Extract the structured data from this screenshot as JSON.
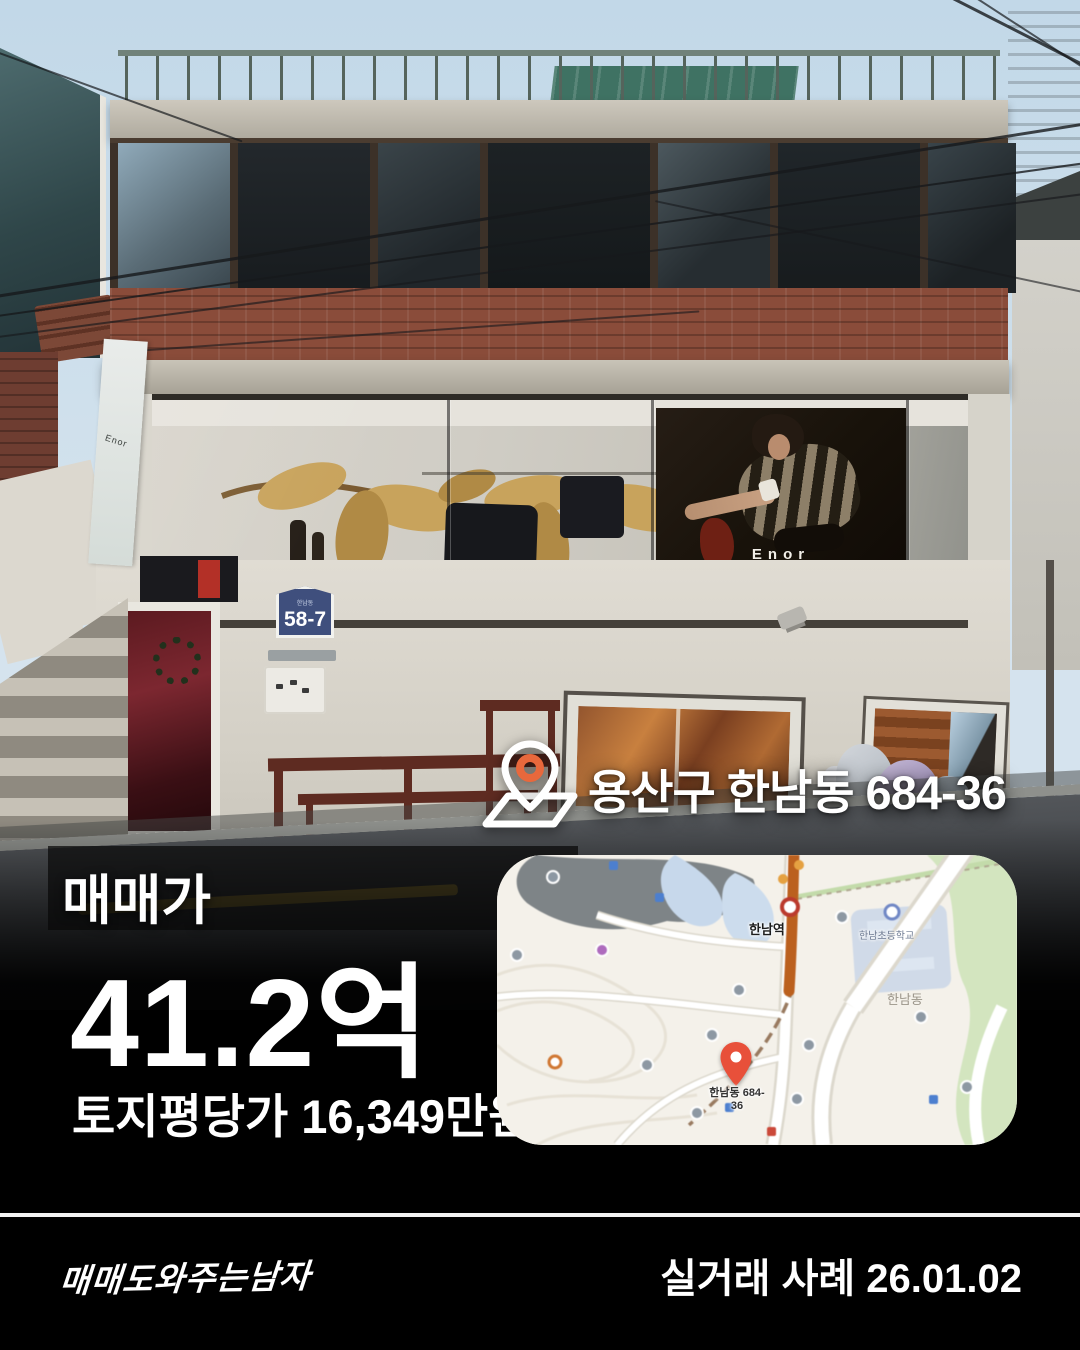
{
  "listing": {
    "location": "용산구 한남동 684-36",
    "price_label": "매매가",
    "price": "41.2억",
    "land_price": "토지평당가 16,349만원",
    "deal_note": "실거래 사례 26.01.02",
    "brand": "매매도와주는남자"
  },
  "photo": {
    "store_sign": "Enor",
    "address_plate": "58-7",
    "address_plate_caption": "한남동"
  },
  "map": {
    "station": "한남역",
    "district": "한남동",
    "school": "한남초등학교",
    "pin_label_line1": "한남동 684-",
    "pin_label_line2": "36",
    "colors": {
      "pin": "#e8503a",
      "highlight_road": "#bf5f1a",
      "park": "#d2e5bd",
      "building_zone": "#ccd8e8",
      "background": "#f4f1ea"
    }
  },
  "colors": {
    "page_background": "#000000",
    "overlay_text": "#ffffff",
    "divider": "#f2f2f2",
    "road_yellow_line": "#d7b84b"
  }
}
